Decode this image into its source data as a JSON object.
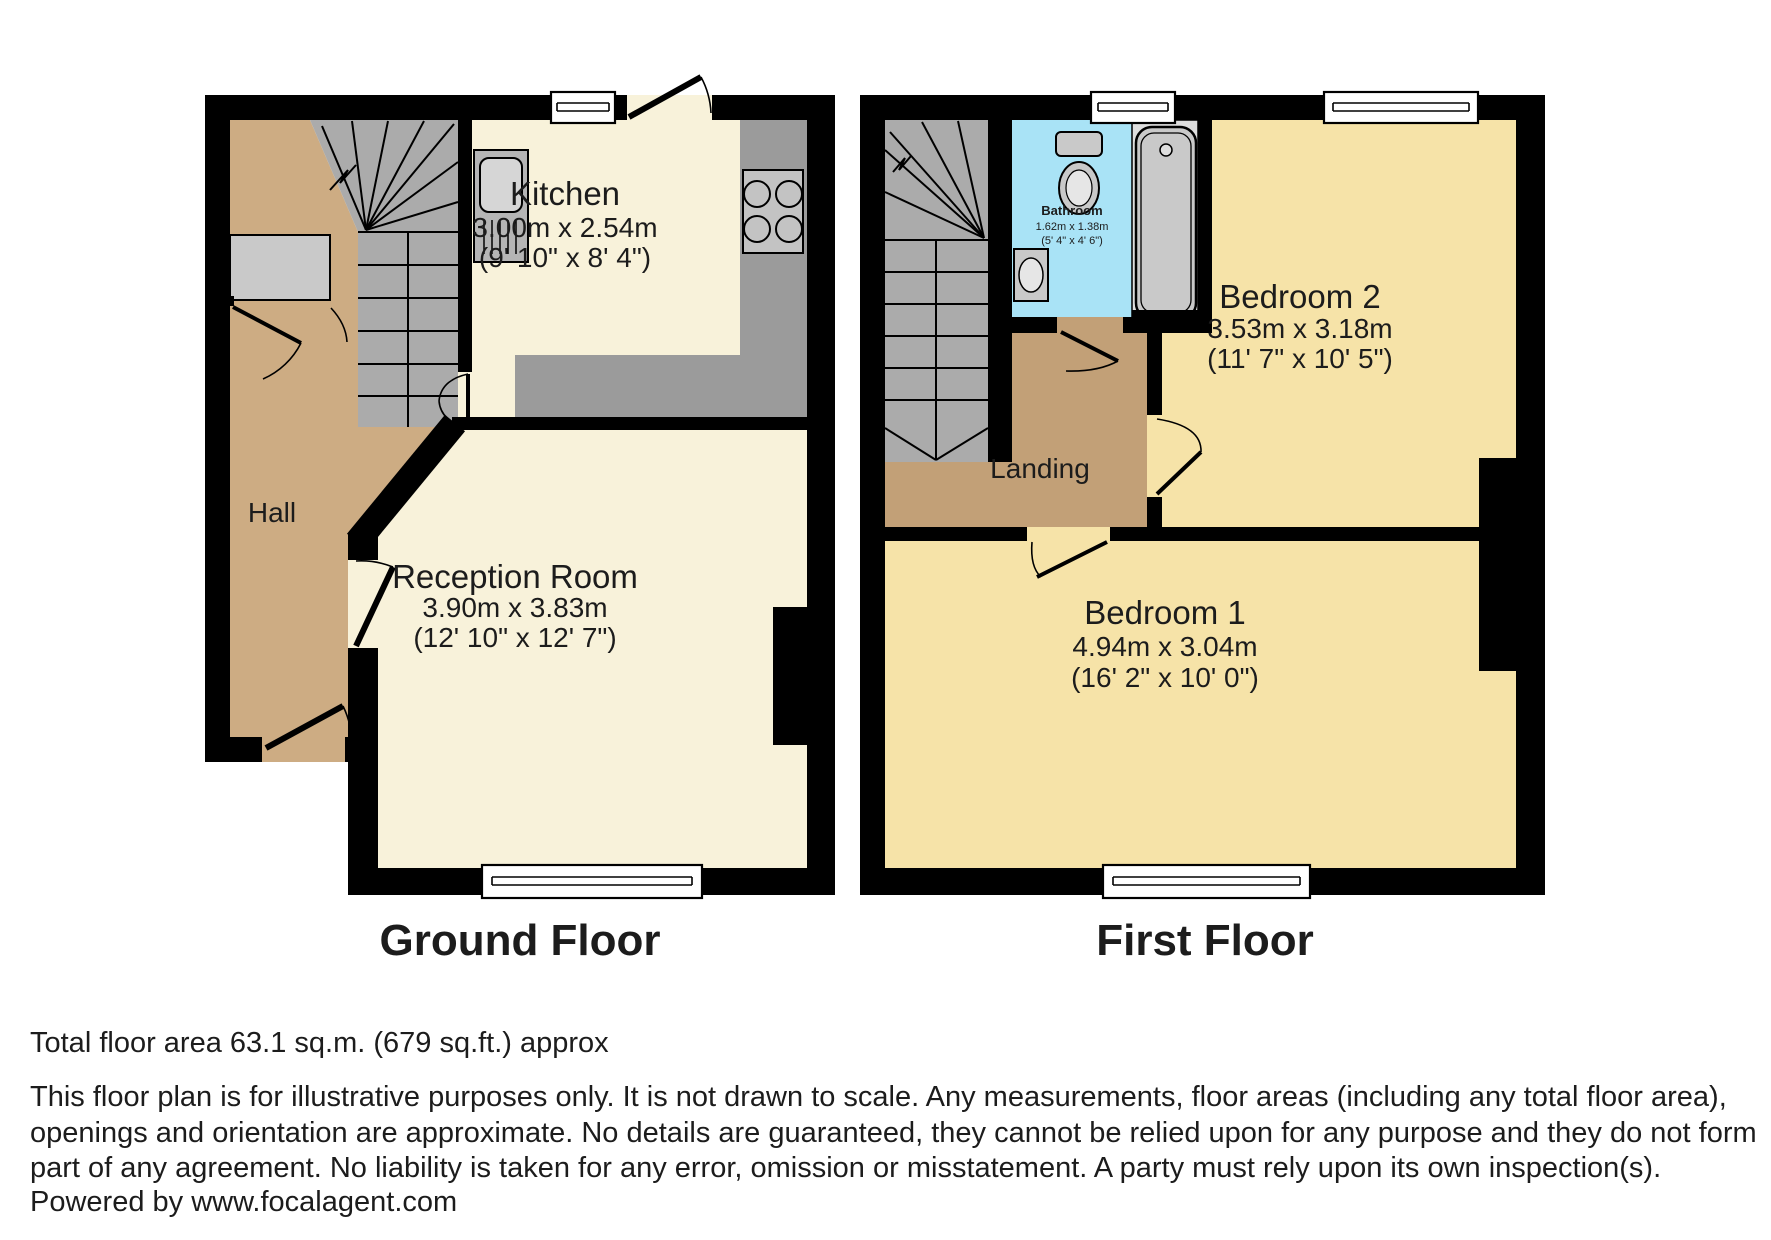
{
  "ground_floor": {
    "title": "Ground Floor",
    "hall": {
      "name": "Hall"
    },
    "kitchen": {
      "name": "Kitchen",
      "metric": "3.00m x 2.54m",
      "imperial": "(9' 10\" x 8' 4\")"
    },
    "reception": {
      "name": "Reception Room",
      "metric": "3.90m x 3.83m",
      "imperial": "(12' 10\" x 12' 7\")"
    }
  },
  "first_floor": {
    "title": "First Floor",
    "landing": {
      "name": "Landing"
    },
    "bathroom": {
      "name": "Bathroom",
      "metric": "1.62m x 1.38m",
      "imperial": "(5' 4\" x 4' 6\")"
    },
    "bedroom2": {
      "name": "Bedroom 2",
      "metric": "3.53m x 3.18m",
      "imperial": "(11' 7\" x 10' 5\")"
    },
    "bedroom1": {
      "name": "Bedroom 1",
      "metric": "4.94m x 3.04m",
      "imperial": "(16' 2\" x 10' 0\")"
    }
  },
  "footer": {
    "total_area": "Total floor area 63.1 sq.m. (679 sq.ft.) approx",
    "disclaimer_lines": [
      "This floor plan is for illustrative purposes only. It is not drawn to scale. Any measurements, floor areas (including any total floor area),",
      "openings and orientation are approximate. No details are guaranteed, they cannot be relied upon for any purpose and they do not form",
      "part of any agreement. No liability is taken for any error, omission or misstatement. A party must rely upon its own inspection(s)."
    ],
    "powered_by": "Powered by www.focalagent.com"
  },
  "colors": {
    "wall": "#000000",
    "floor_cream": "#f8f2da",
    "bedroom_yellow": "#f6e3a8",
    "hall_tan": "#cdac83",
    "landing_tan": "#c2a077",
    "stairs_gray": "#ababab",
    "counter_gray": "#9b9b9b",
    "bathroom_blue": "#a9e3f6",
    "fixture_gray": "#c9c9c9"
  }
}
